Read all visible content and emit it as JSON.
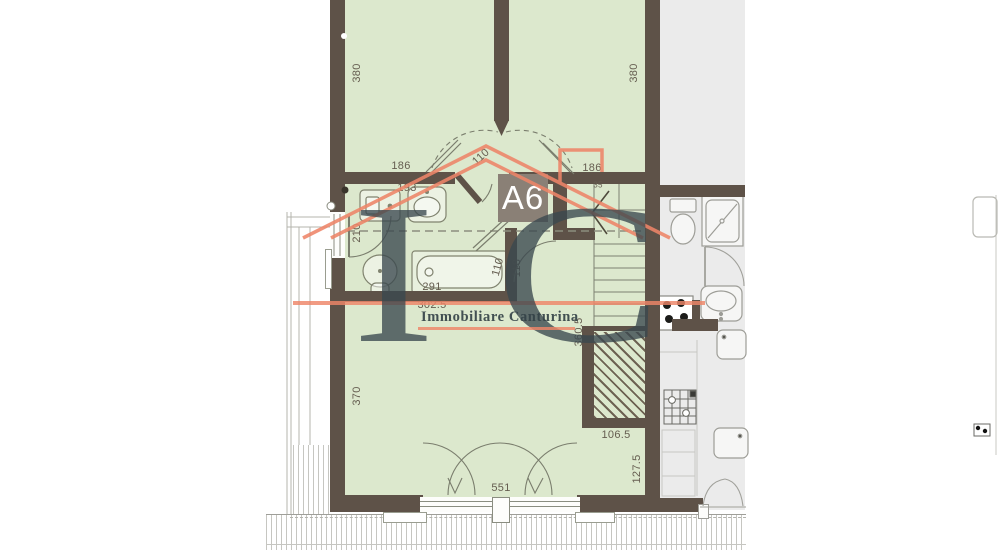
{
  "unit": {
    "label": "A6"
  },
  "watermark": {
    "monogram": "IC",
    "company": "Immobiliare Canturina"
  },
  "dimensions": {
    "wall_left_height": "380",
    "wall_right_height": "380",
    "bedroom_left_width": "186",
    "bedroom_right_width": "186",
    "bedroom_doors": "110",
    "bath_sink_width": "193",
    "left_window_width": "210",
    "bathtub_length": "291",
    "bathroom_width": "302.5",
    "landing_door_width": "110",
    "landing_width": "118",
    "stair_start": "35",
    "stairwell_height": "360.5",
    "living_room_height": "370",
    "void_width": "106.5",
    "void_height": "127.5",
    "living_room_width": "551"
  },
  "colors": {
    "wall": "#5e5248",
    "room_fill": "#dce8cd",
    "neighbor_fill": "#ebebeb",
    "accent": "#ee8568",
    "monogram": "#3a4850",
    "dimension_text": "#655d50",
    "unit_box": "#8a8076"
  }
}
